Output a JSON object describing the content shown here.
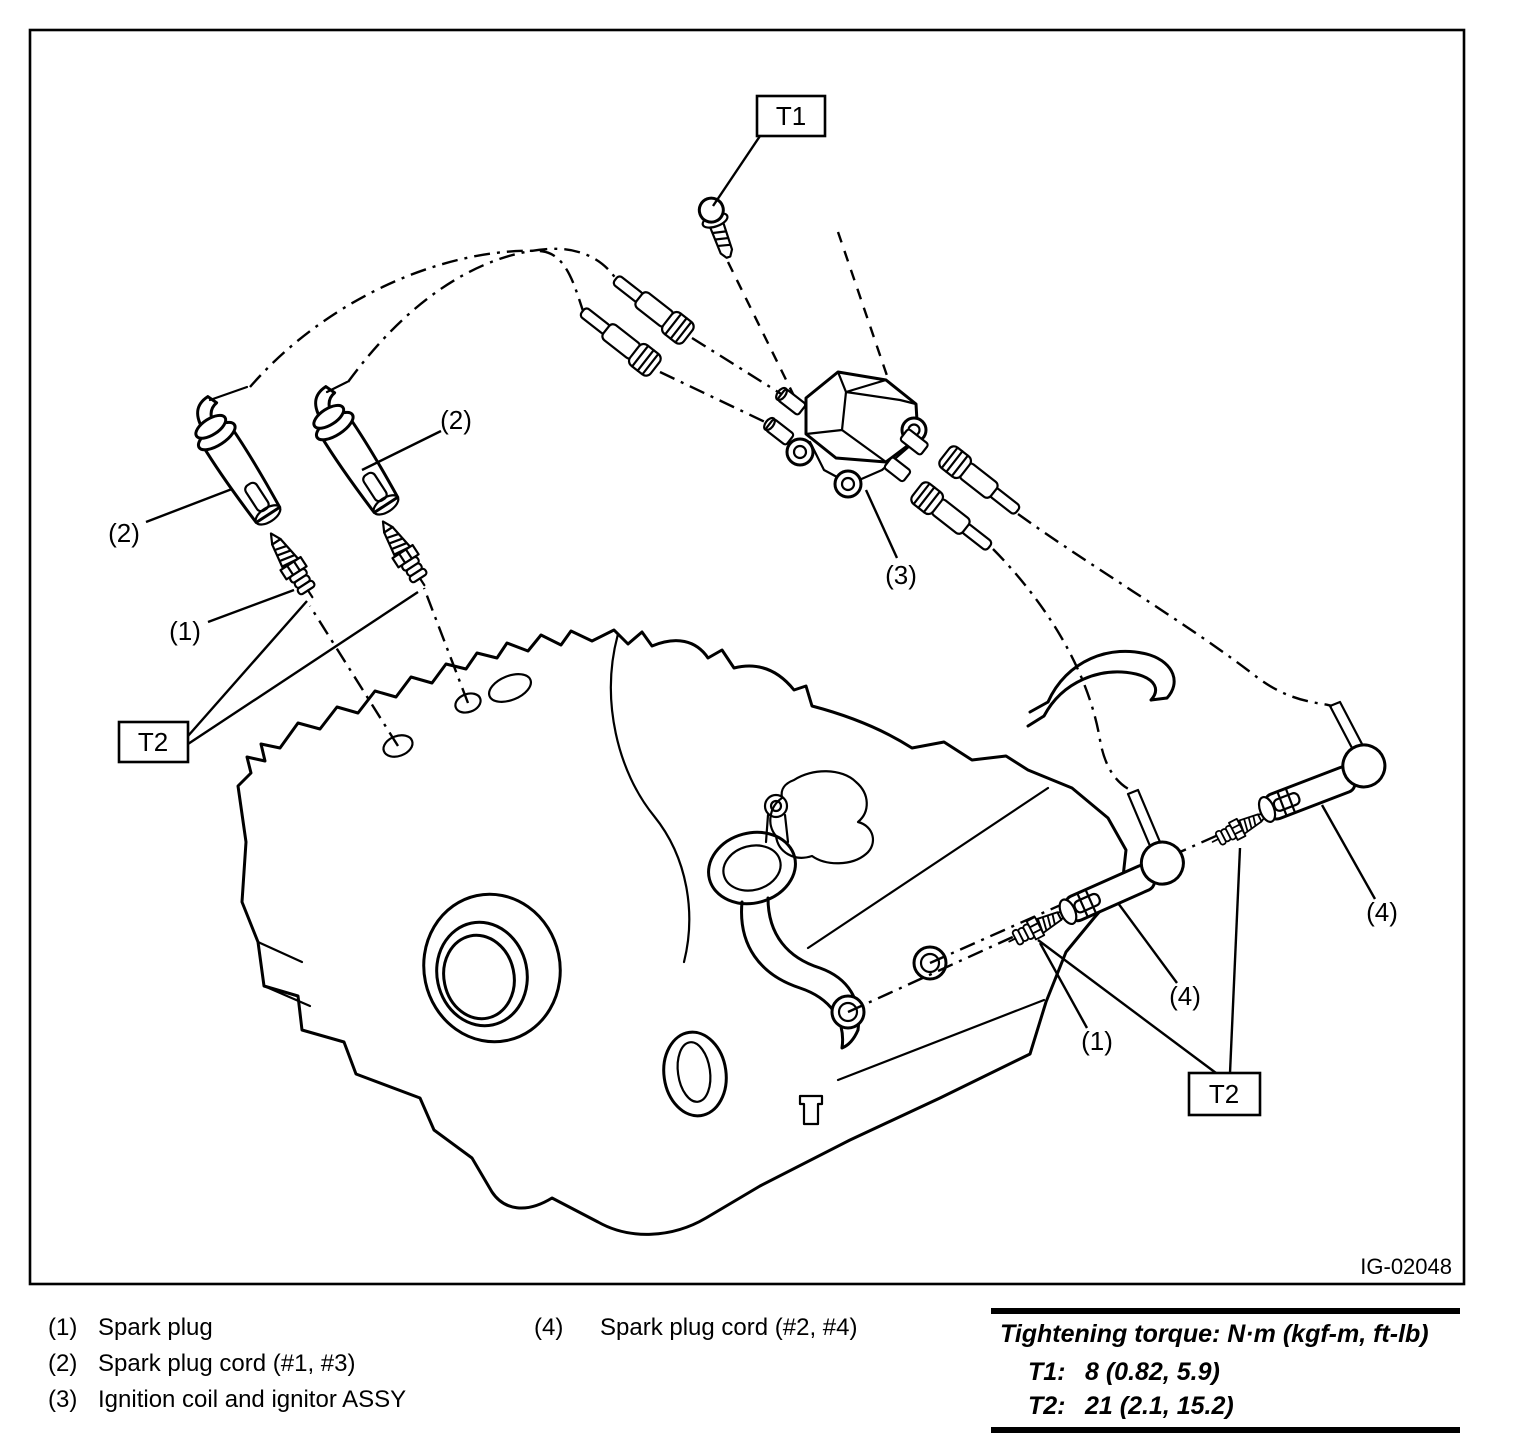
{
  "figure": {
    "id_label": "IG-02048",
    "description": "Exploded line diagram of engine ignition components: spark plugs, spark plug cords, ignition coil and ignitor assembly"
  },
  "callouts": {
    "t1": "T1",
    "t2": "T2",
    "n1": "(1)",
    "n2": "(2)",
    "n3": "(3)",
    "n4": "(4)"
  },
  "legend": {
    "items": [
      {
        "num": "(1)",
        "label": "Spark plug"
      },
      {
        "num": "(2)",
        "label": "Spark plug cord (#1, #3)"
      },
      {
        "num": "(3)",
        "label": "Ignition coil and ignitor ASSY"
      },
      {
        "num": "(4)",
        "label": "Spark plug cord (#2, #4)"
      }
    ]
  },
  "torque_table": {
    "title": "Tightening torque: N·m (kgf-m, ft-lb)",
    "rows": [
      {
        "key": "T1:",
        "value": "8 (0.82, 5.9)"
      },
      {
        "key": "T2:",
        "value": "21 (2.1, 15.2)"
      }
    ]
  },
  "colors": {
    "ink": "#000000",
    "paper": "#ffffff"
  }
}
